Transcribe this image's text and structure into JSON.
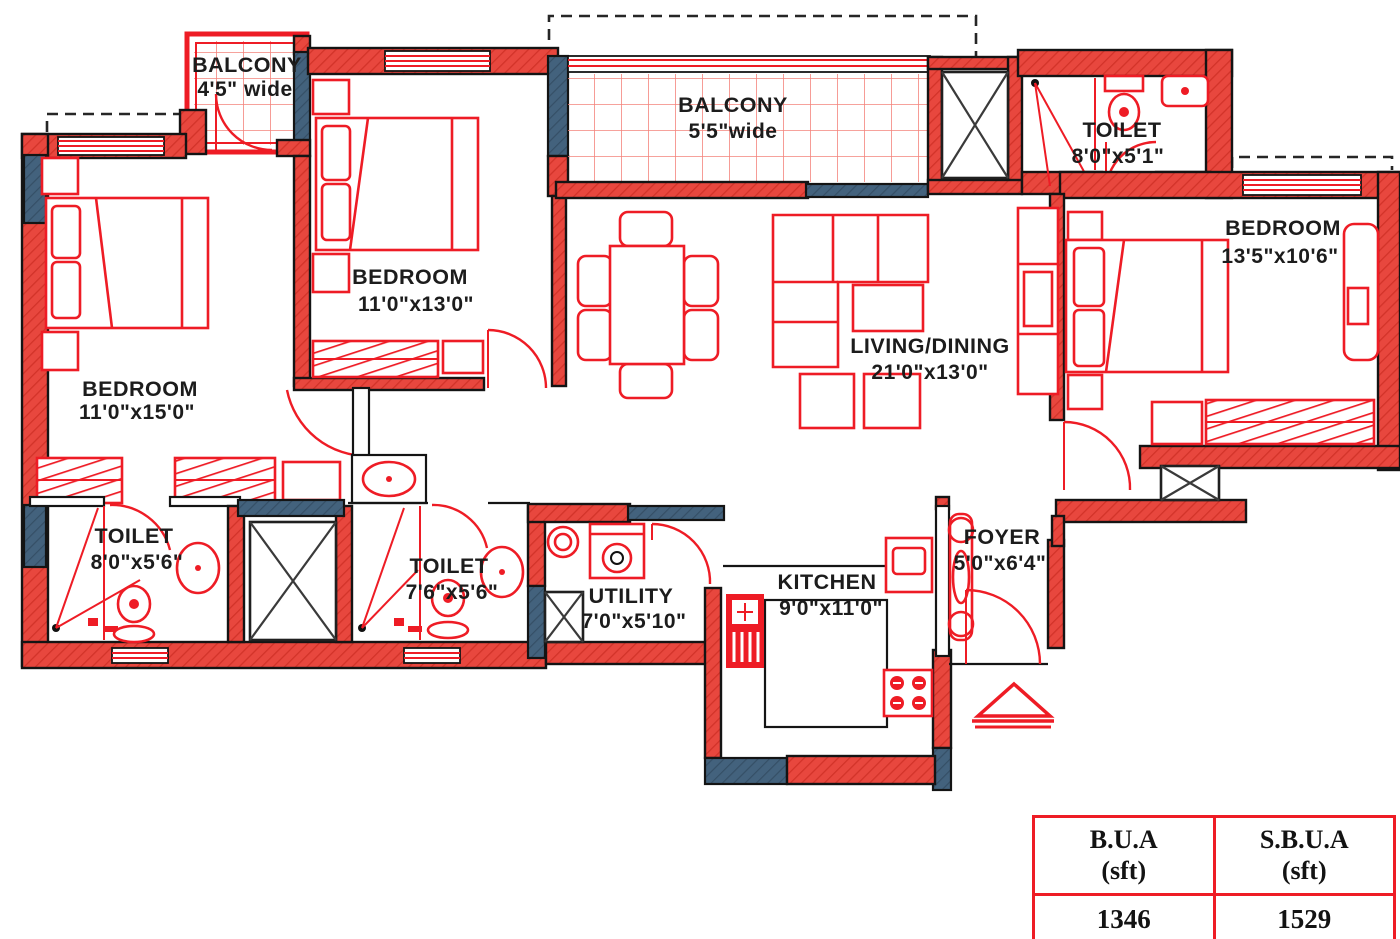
{
  "title": "Apartment floor plan",
  "colors": {
    "drawing_red": "#ee1c25",
    "wall_red": "#e8473e",
    "wall_blue": "#42617c",
    "grid_red": "#f3837b",
    "text_black": "#1c1c1c"
  },
  "rooms": [
    {
      "id": "balcony-top-left",
      "name": "BALCONY",
      "dims": "4'5\" wide"
    },
    {
      "id": "bedroom-top",
      "name": "BEDROOM",
      "dims": "11'0\"x13'0\""
    },
    {
      "id": "balcony-top-center",
      "name": "BALCONY",
      "dims": "5'5\"wide"
    },
    {
      "id": "toilet-top-right",
      "name": "TOILET",
      "dims": "8'0\"x5'1\""
    },
    {
      "id": "bedroom-right",
      "name": "BEDROOM",
      "dims": "13'5\"x10'6\""
    },
    {
      "id": "bedroom-left",
      "name": "BEDROOM",
      "dims": "11'0\"x15'0\""
    },
    {
      "id": "living-dining",
      "name": "LIVING/DINING",
      "dims": "21'0\"x13'0\""
    },
    {
      "id": "toilet-bottom-left",
      "name": "TOILET",
      "dims": "8'0\"x5'6\""
    },
    {
      "id": "toilet-bottom-mid",
      "name": "TOILET",
      "dims": "7'6\"x5'6\""
    },
    {
      "id": "utility",
      "name": "UTILITY",
      "dims": "7'0\"x5'10\""
    },
    {
      "id": "kitchen",
      "name": "KITCHEN",
      "dims": "9'0\"x11'0\""
    },
    {
      "id": "foyer",
      "name": "FOYER",
      "dims": "5'0\"x6'4\""
    }
  ],
  "area_table": {
    "header": [
      {
        "title": "B.U.A",
        "unit": "(sft)"
      },
      {
        "title": "S.B.U.A",
        "unit": "(sft)"
      }
    ],
    "values": [
      "1346",
      "1529"
    ]
  }
}
